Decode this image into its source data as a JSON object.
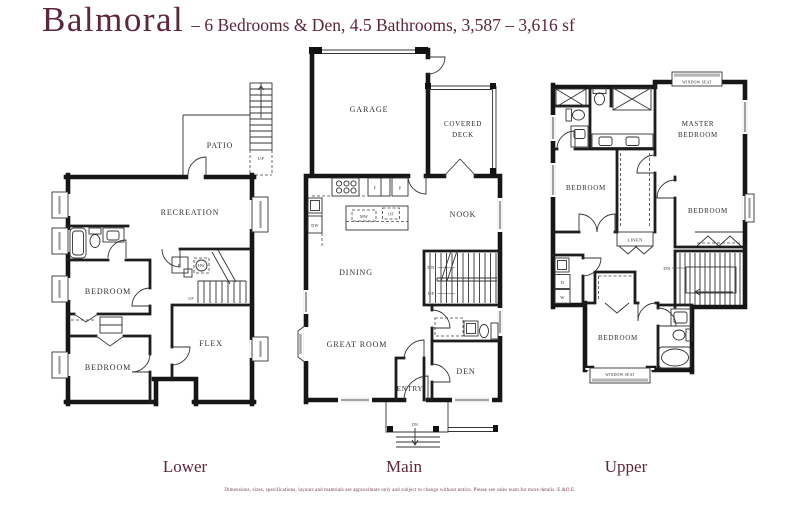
{
  "header": {
    "plan_name": "Balmoral",
    "subtitle": "– 6 Bedrooms & Den, 4.5 Bathrooms, 3,587 – 3,616 sf"
  },
  "colors": {
    "accent": "#5f2538",
    "wall": "#161616",
    "window_glass": "#a0a0a0"
  },
  "floors": {
    "lower": {
      "label": "Lower",
      "rooms": {
        "patio": "PATIO",
        "recreation": "RECREATION",
        "bedroom_a": "BEDROOM",
        "bedroom_b": "BEDROOM",
        "flex": "FLEX"
      },
      "marks": {
        "stairs_up_exterior": "UP",
        "stairs_up": "UP",
        "freezer": "F",
        "hot_water_tank": "HW"
      }
    },
    "main": {
      "label": "Main",
      "rooms": {
        "garage": "GARAGE",
        "covered_deck_line1": "COVERED",
        "covered_deck_line2": "DECK",
        "nook": "NOOK",
        "dining": "DINING",
        "great_room": "GREAT ROOM",
        "entry": "ENTRY",
        "den": "DEN"
      },
      "marks": {
        "stairs_dn": "DN",
        "stairs_up": "UP",
        "porch_dn": "DN",
        "microwave": "MW",
        "oven": "OF",
        "fridge": "F",
        "pantry": "P",
        "dishwasher": "DW"
      }
    },
    "upper": {
      "label": "Upper",
      "rooms": {
        "master_line1": "MASTER",
        "master_line2": "BEDROOM",
        "bedroom_a": "BEDROOM",
        "bedroom_b": "BEDROOM",
        "bedroom_c": "BEDROOM",
        "linen": "LINEN"
      },
      "marks": {
        "window_seat_top": "WINDOW SEAT",
        "window_seat_bottom": "WINDOW SEAT",
        "stairs_dn": "DN",
        "dryer": "D",
        "washer": "W"
      }
    }
  },
  "footer": {
    "disclaimer": "Dimensions, sizes, specifications, layouts and materials are approximate only and subject to change without notice. Please see sales team for more details. E.&O.E."
  }
}
